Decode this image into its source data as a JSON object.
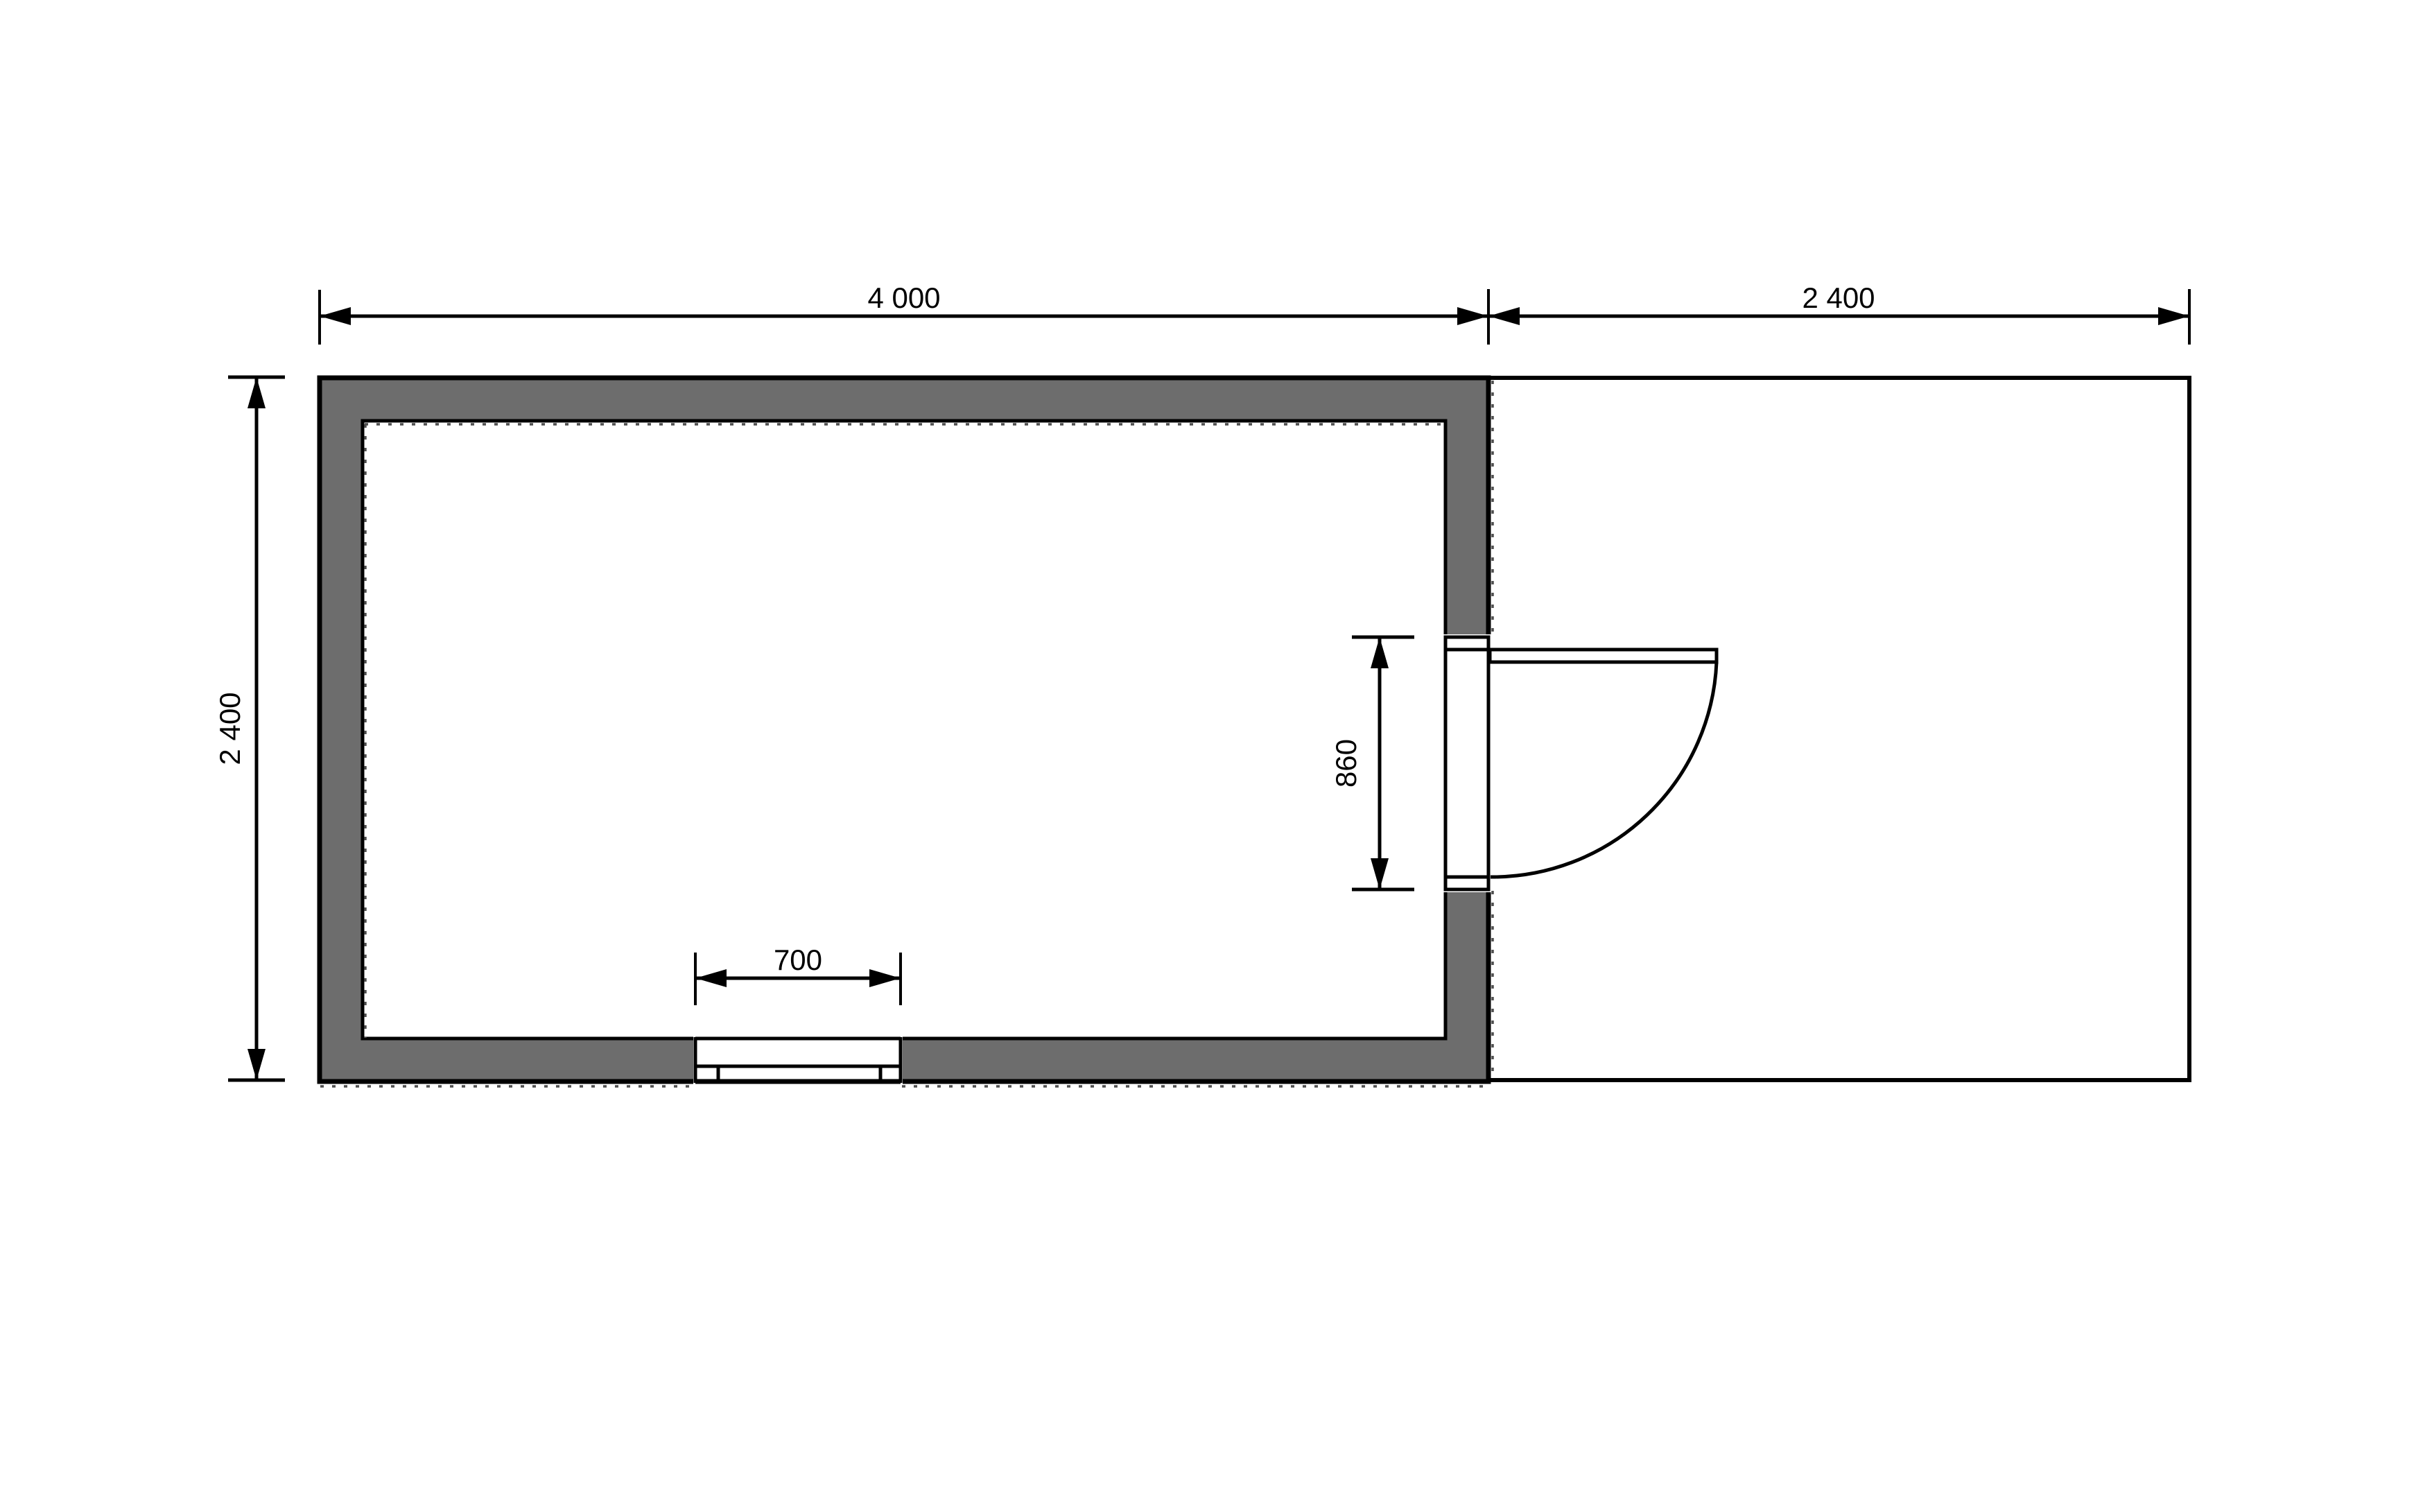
{
  "drawing": {
    "type": "floor-plan",
    "units": "mm",
    "description": "Small building plan with open terrace, door with swing arc and window"
  },
  "dims": {
    "building_width": "4 000",
    "terrace_width": "2 400",
    "building_depth": "2 400",
    "door_opening": "860",
    "window_width": "700"
  },
  "colors": {
    "wall_fill": "#6d6d6d",
    "line": "#000000",
    "hidden_line": "#4f4f4f",
    "background": "#ffffff"
  }
}
